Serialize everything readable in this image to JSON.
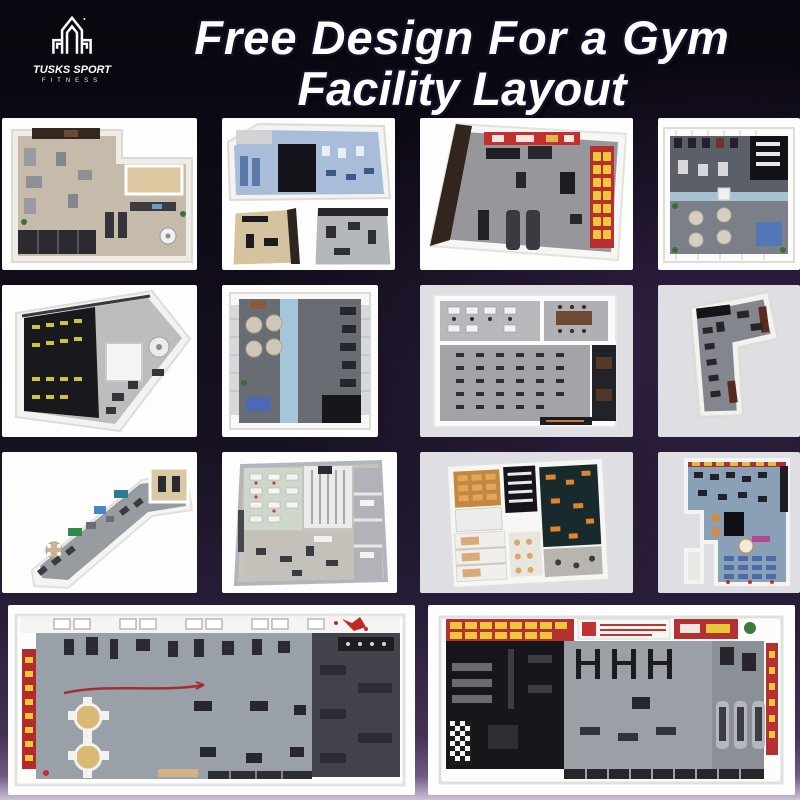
{
  "header": {
    "logo": {
      "brand": "TUSKS SPORT",
      "subtitle": "FITNESS",
      "emblem": "tusks-towers-monogram"
    },
    "title": {
      "line1": "Free Design For a Gym",
      "line2": "Facility Layout"
    }
  },
  "theme": {
    "background_top": "#0a070f",
    "background_bottom": "#cdc2d8",
    "title_color": "#ffffff",
    "title_outline": "#151028",
    "tile_white": "#fdfdfd",
    "tile_gray": "#dfdfe3",
    "accent_red": "#b83030",
    "accent_yellow": "#ecc93c",
    "accent_blue": "#a6c2d2"
  },
  "gallery": {
    "items": [
      {
        "id": "thumb-1",
        "label": "L-shaped gym with beige tile floor and wood studio"
      },
      {
        "id": "thumb-2",
        "label": "Composite of three gym renders with blue training floor"
      },
      {
        "id": "thumb-3",
        "label": "Gym with red wall banners and yellow wall mats"
      },
      {
        "id": "thumb-4",
        "label": "Square gym with blue walkway stripe and massage pods"
      },
      {
        "id": "thumb-5",
        "label": "Fan-shaped gym with black strength zone"
      },
      {
        "id": "thumb-6",
        "label": "Square gym with vertical blue runway and lounge pods"
      },
      {
        "id": "thumb-7",
        "label": "Spin studio with office rooms and bike rows"
      },
      {
        "id": "thumb-8",
        "label": "Tilted L-shaped strength gym"
      },
      {
        "id": "thumb-9",
        "label": "Long diagonal leisure gym hall"
      },
      {
        "id": "thumb-10",
        "label": "Wellness club plan with lounger rows and cabins"
      },
      {
        "id": "thumb-11",
        "label": "Multi-room fitness club with dark training hall"
      },
      {
        "id": "thumb-12",
        "label": "Irregular club plan with blue lounger rows"
      },
      {
        "id": "thumb-13",
        "label": "Wide gym hall with skylights and red banner wall"
      },
      {
        "id": "thumb-14",
        "label": "Wide gym hall with red mat wall and treadmill row"
      }
    ]
  }
}
